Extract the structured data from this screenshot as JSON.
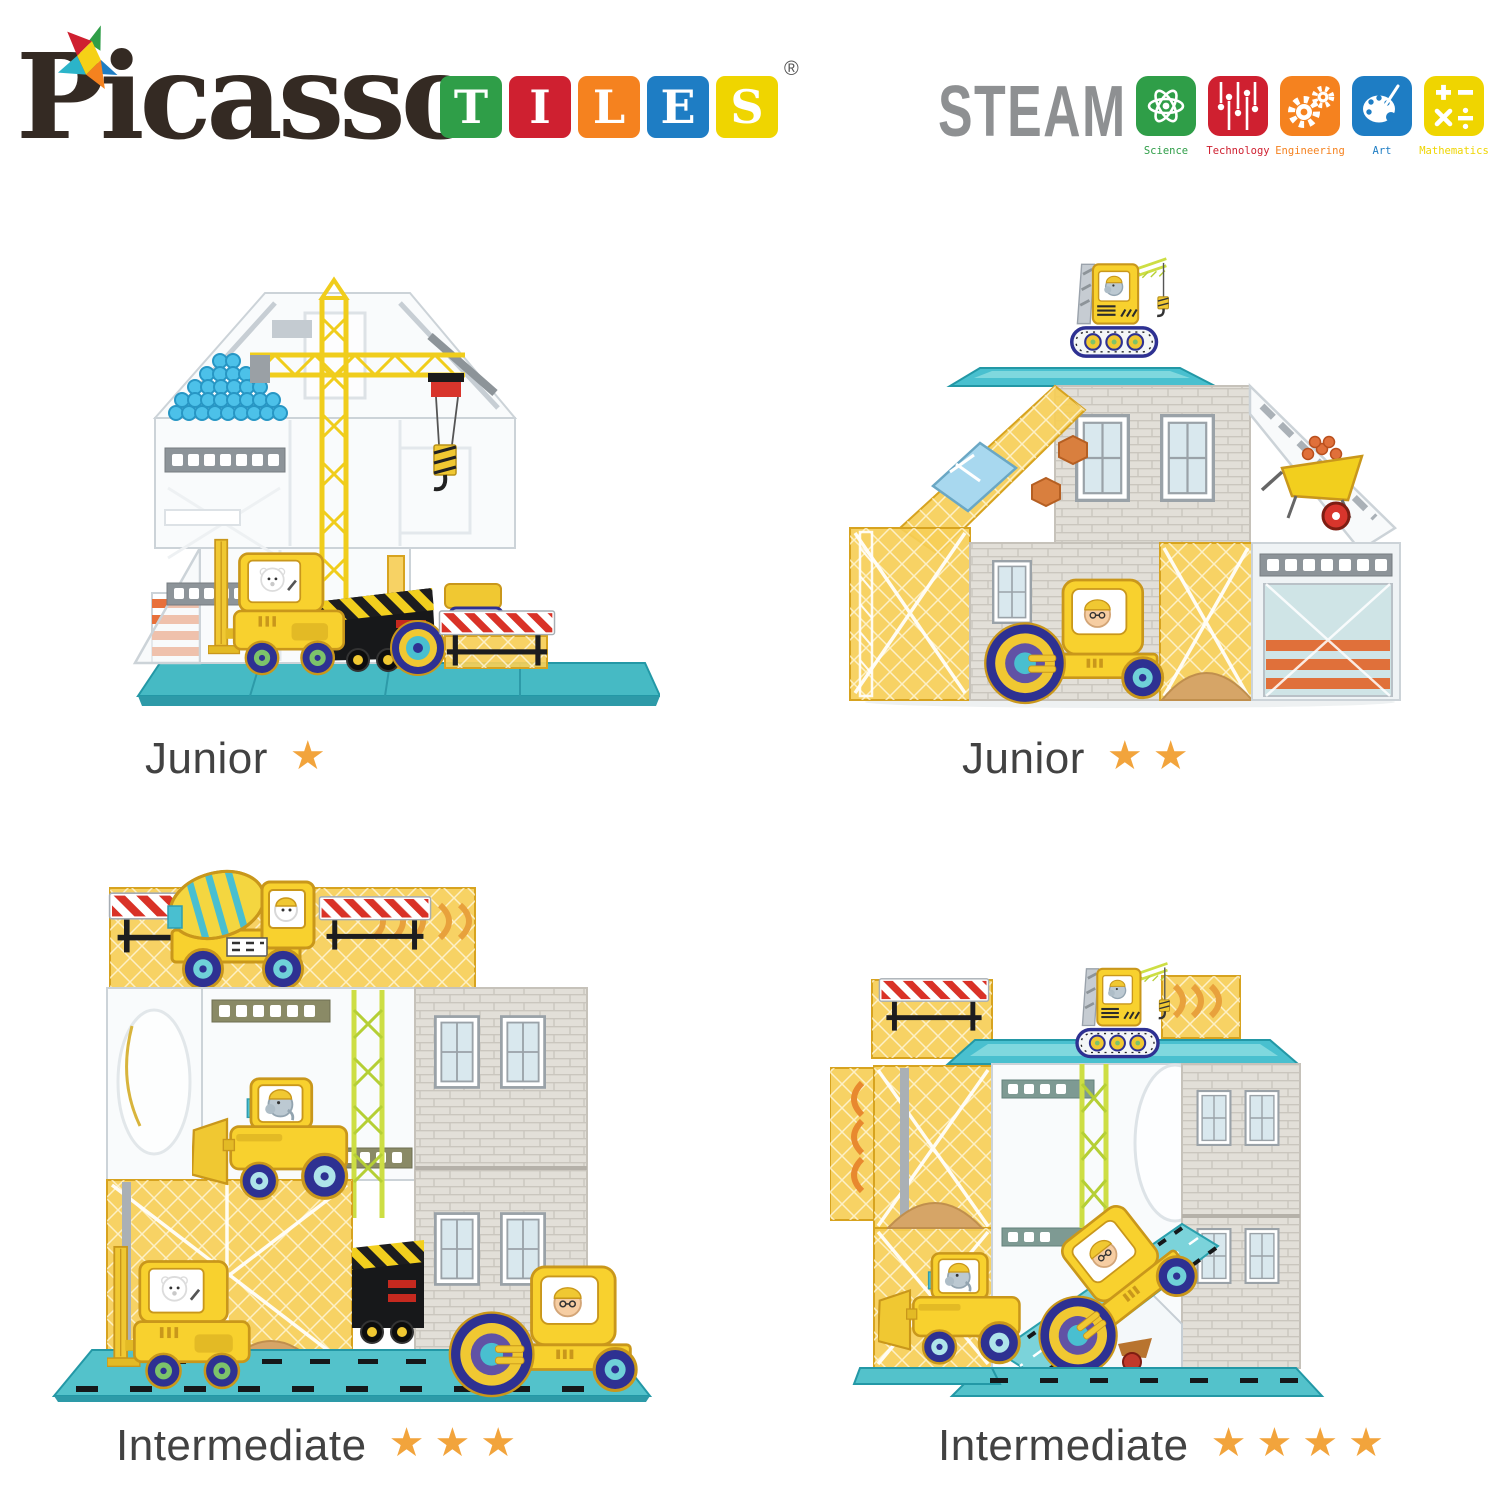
{
  "page": {
    "background": "#ffffff"
  },
  "logo": {
    "brand": "Picasso",
    "registered_mark": "®",
    "text_color": "#342a23",
    "tiles": [
      {
        "letter": "T",
        "color": "#2f9e48"
      },
      {
        "letter": "I",
        "color": "#cf2030"
      },
      {
        "letter": "L",
        "color": "#f5821f"
      },
      {
        "letter": "E",
        "color": "#1e7dc4"
      },
      {
        "letter": "S",
        "color": "#efd500"
      }
    ]
  },
  "steam": {
    "title": "STEAM",
    "title_color": "#8e9092",
    "items": [
      {
        "label": "Science",
        "color": "#2f9e48",
        "icon": "atom-icon"
      },
      {
        "label": "Technology",
        "color": "#cf2030",
        "icon": "circuit-icon"
      },
      {
        "label": "Engineering",
        "color": "#f5821f",
        "icon": "gears-icon"
      },
      {
        "label": "Art",
        "color": "#1e7dc4",
        "icon": "palette-icon"
      },
      {
        "label": "Mathematics",
        "color": "#efd500",
        "icon": "math-icon"
      }
    ]
  },
  "difficulty": {
    "star_color": "#f2a43c"
  },
  "builds": [
    {
      "level": "Junior",
      "stars": 1,
      "stars_display": "★",
      "scene": "House frame of clear tiles with yellow tower crane, stacked blue pipes, forklift, dump truck, road roller and red-white striped barrier"
    },
    {
      "level": "Junior",
      "stars": 2,
      "stars_display": "★★",
      "scene": "House with crawler crane on roof, gray brick walls, blue window panel, wheelbarrow with bricks, road roller and striped garage door"
    },
    {
      "level": "Intermediate",
      "stars": 3,
      "stars_display": "★★★",
      "scene": "Two-story build with cement mixer truck and safety barriers on top, wheel loader, forklift, dump truck and road roller on teal base"
    },
    {
      "level": "Intermediate",
      "stars": 4,
      "stars_display": "★★★★",
      "scene": "Build with crawler crane on top, safety barrier, chevron panels, wheel loader and road roller driving down a teal ramp"
    }
  ]
}
